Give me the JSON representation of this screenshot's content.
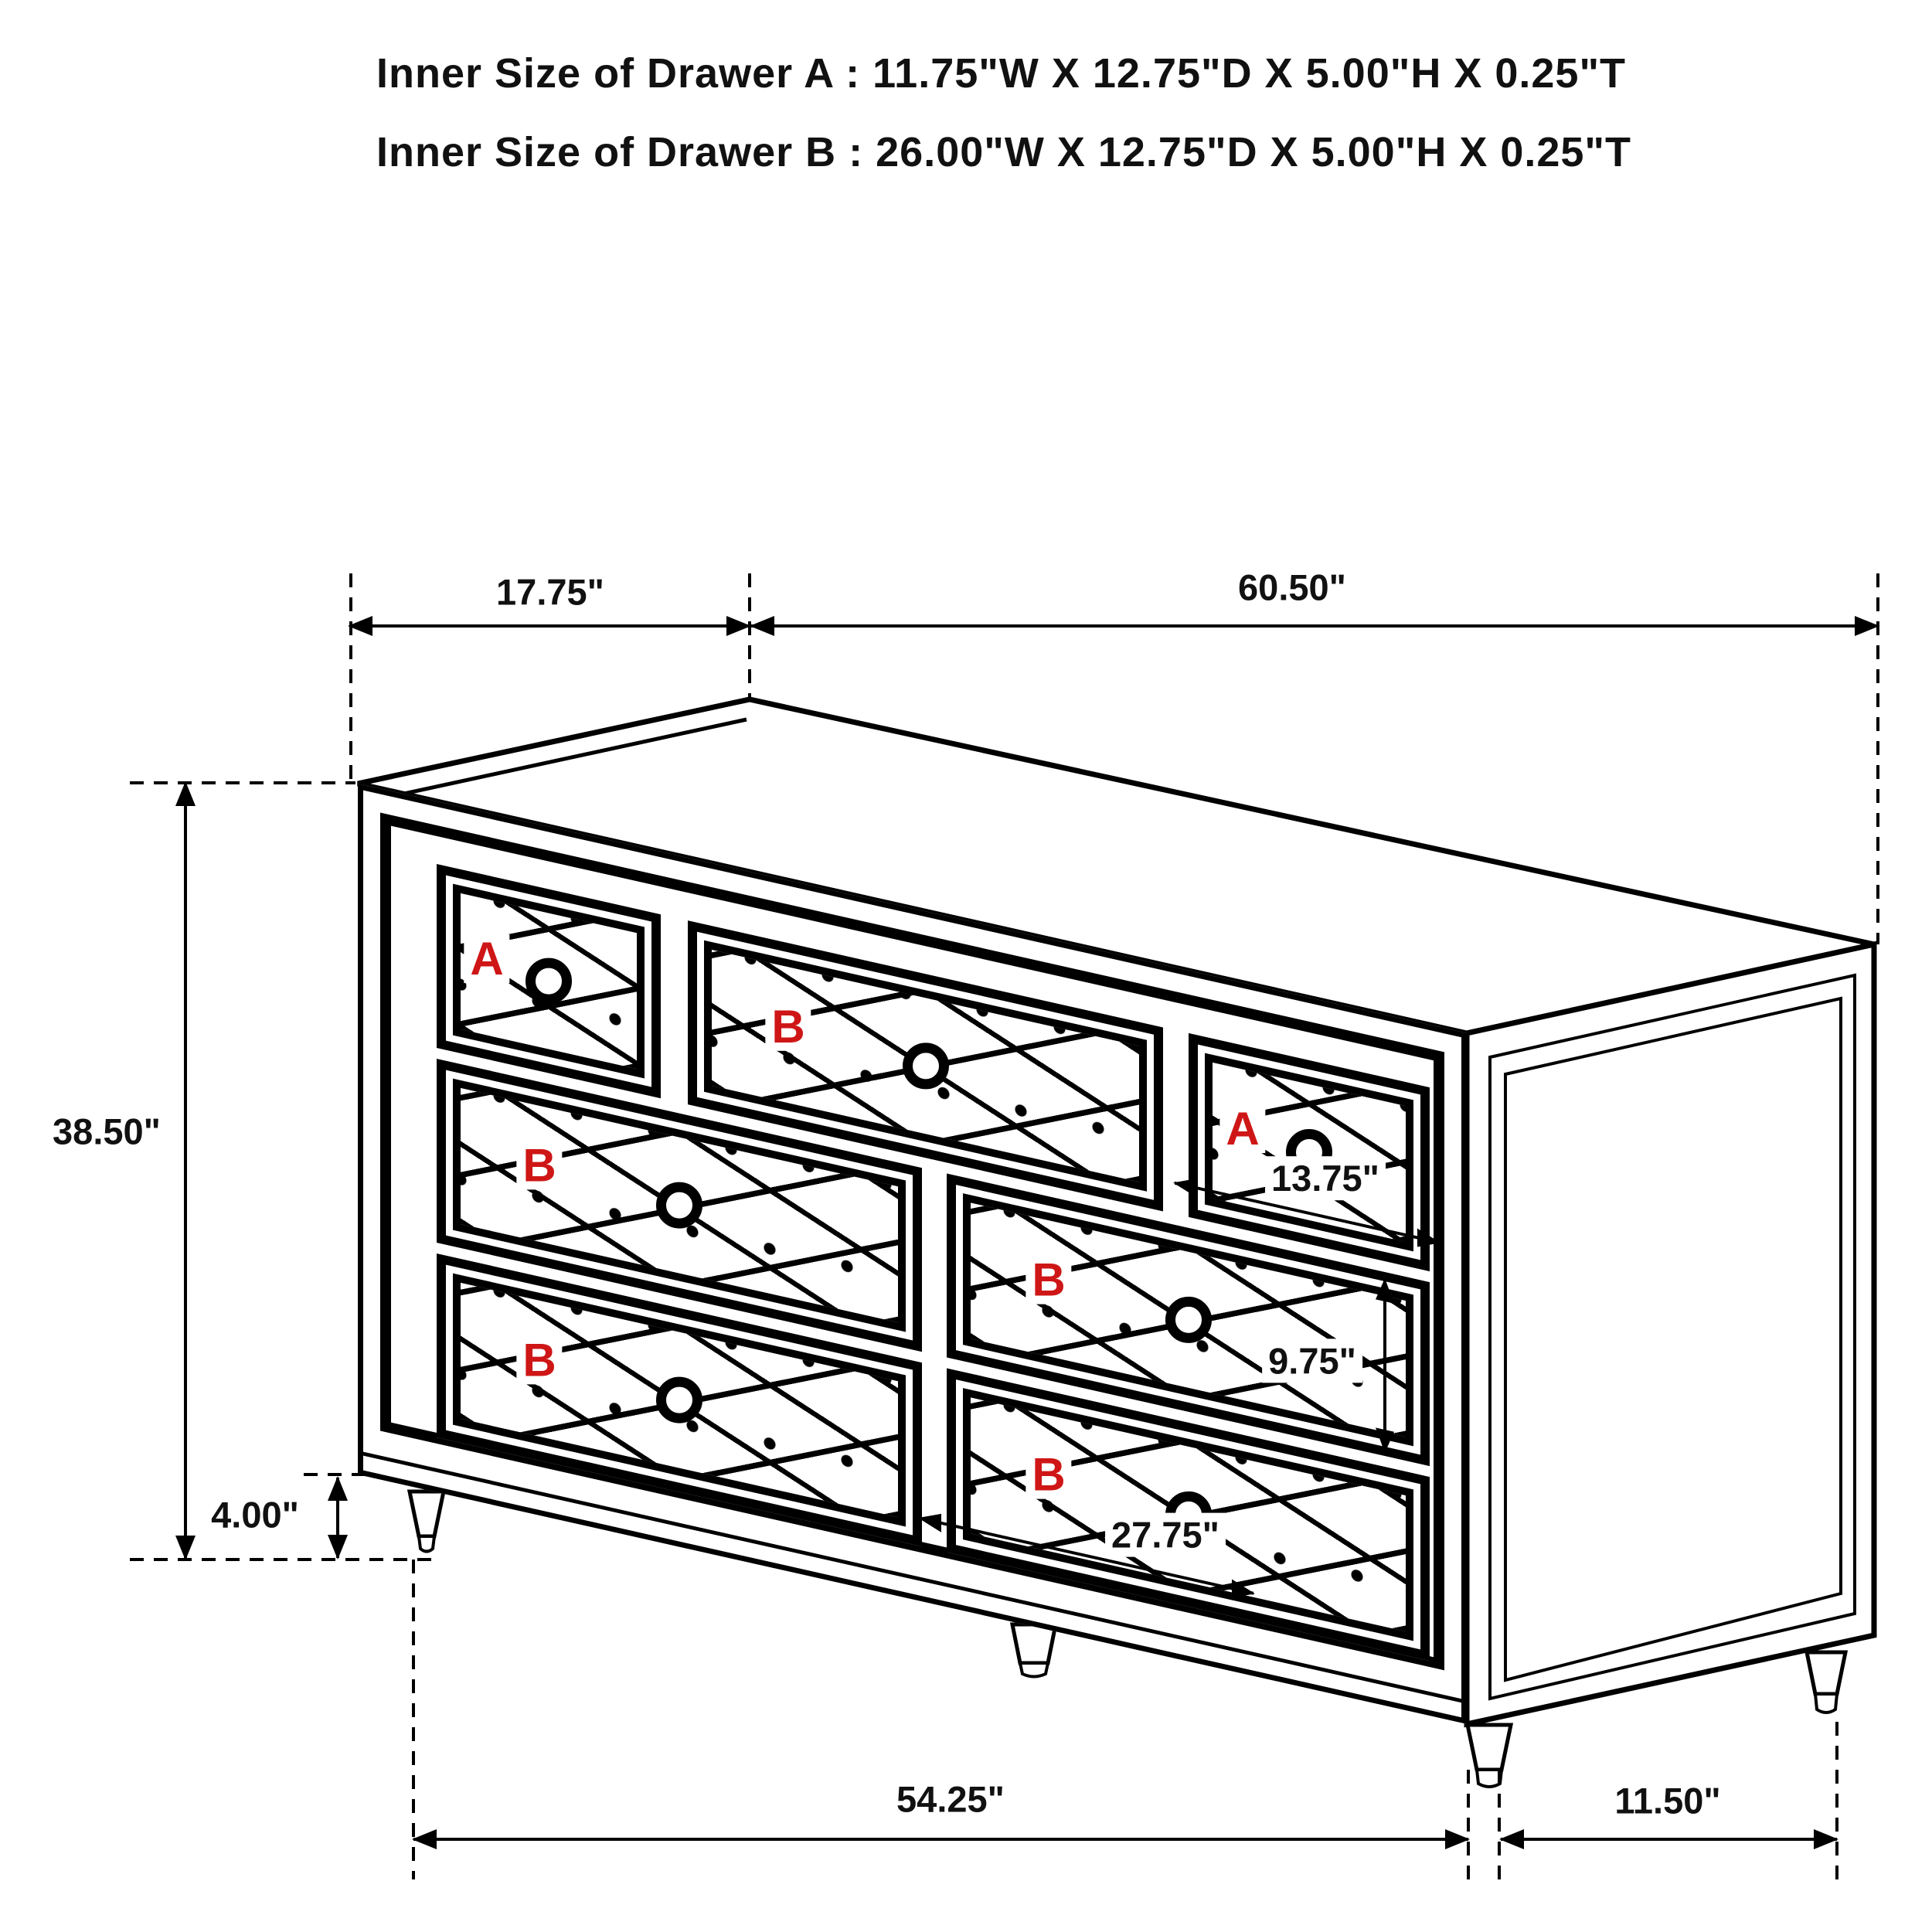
{
  "header": {
    "line1": "Inner Size of Drawer A : 11.75\"W X 12.75\"D X 5.00\"H X 0.25\"T",
    "line2": "Inner Size of Drawer B : 26.00\"W X 12.75\"D X 5.00\"H X 0.25\"T"
  },
  "dimensions": {
    "top_depth": "17.75\"",
    "top_width": "60.50\"",
    "overall_height": "38.50\"",
    "leg_height": "4.00\"",
    "drawer_a_width": "13.75\"",
    "drawer_b_height": "9.75\"",
    "drawer_b_width": "27.75\"",
    "base_front_width": "54.25\"",
    "base_side_depth": "11.50\""
  },
  "drawers": [
    {
      "id": "top-left",
      "label": "A"
    },
    {
      "id": "top-middle",
      "label": "B"
    },
    {
      "id": "top-right",
      "label": "A"
    },
    {
      "id": "middle-left",
      "label": "B"
    },
    {
      "id": "middle-right",
      "label": "B"
    },
    {
      "id": "bottom-left",
      "label": "B"
    },
    {
      "id": "bottom-right",
      "label": "B"
    }
  ],
  "colors": {
    "line": "#000000",
    "drawer_label_red": "#cf1616",
    "background": "#ffffff"
  }
}
